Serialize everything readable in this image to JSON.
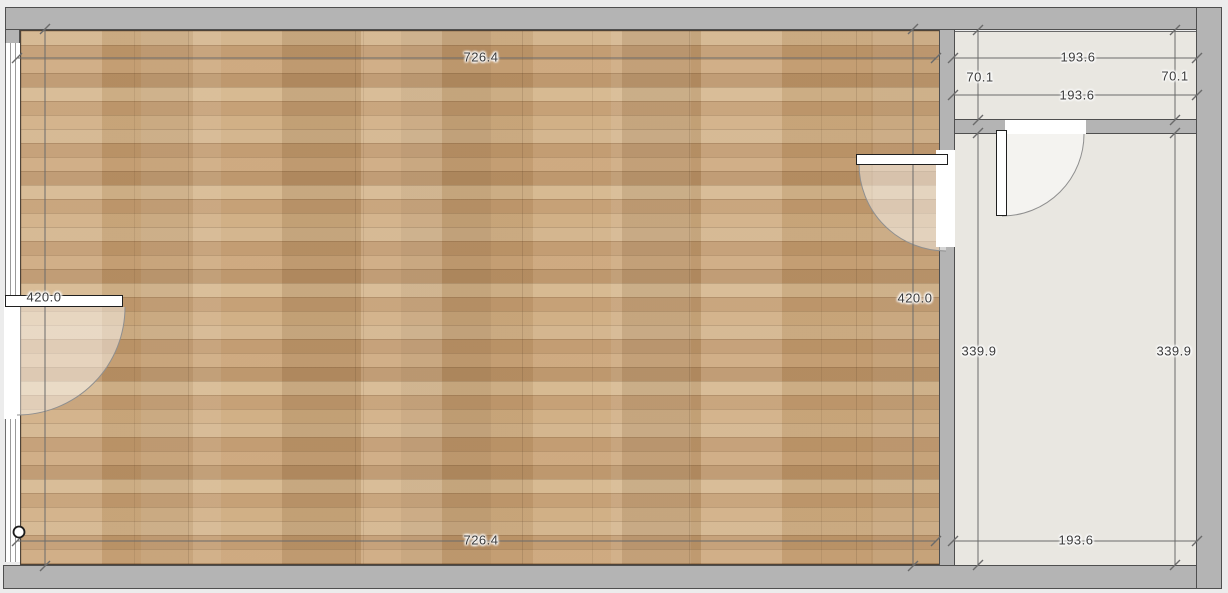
{
  "plan": {
    "rooms": [
      {
        "id": "main-room",
        "floor": "wood-parquet"
      },
      {
        "id": "hall",
        "floor": "light-gray"
      },
      {
        "id": "side-room",
        "floor": "light-gray"
      }
    ],
    "dims": {
      "main_top": "726.4",
      "main_bottom": "726.4",
      "main_left": "420.0",
      "main_right": "420.0",
      "hall_top": "193.6",
      "hall_inner": "193.6",
      "hall_left": "70.1",
      "hall_right": "70.1",
      "side_left": "339.9",
      "side_right": "339.9",
      "side_bottom": "193.6"
    },
    "colors": {
      "wall_fill": "#b4b4b4",
      "wall_outline": "#4f4f4f",
      "floor_light": "#e9e7e1",
      "wood_base": "#c5a277",
      "dim_line": "#6b6b6b",
      "dim_text": "#3a3a3a",
      "page_background": "#ececec",
      "door_swing_tint": "rgba(255,255,255,0.45)"
    }
  }
}
